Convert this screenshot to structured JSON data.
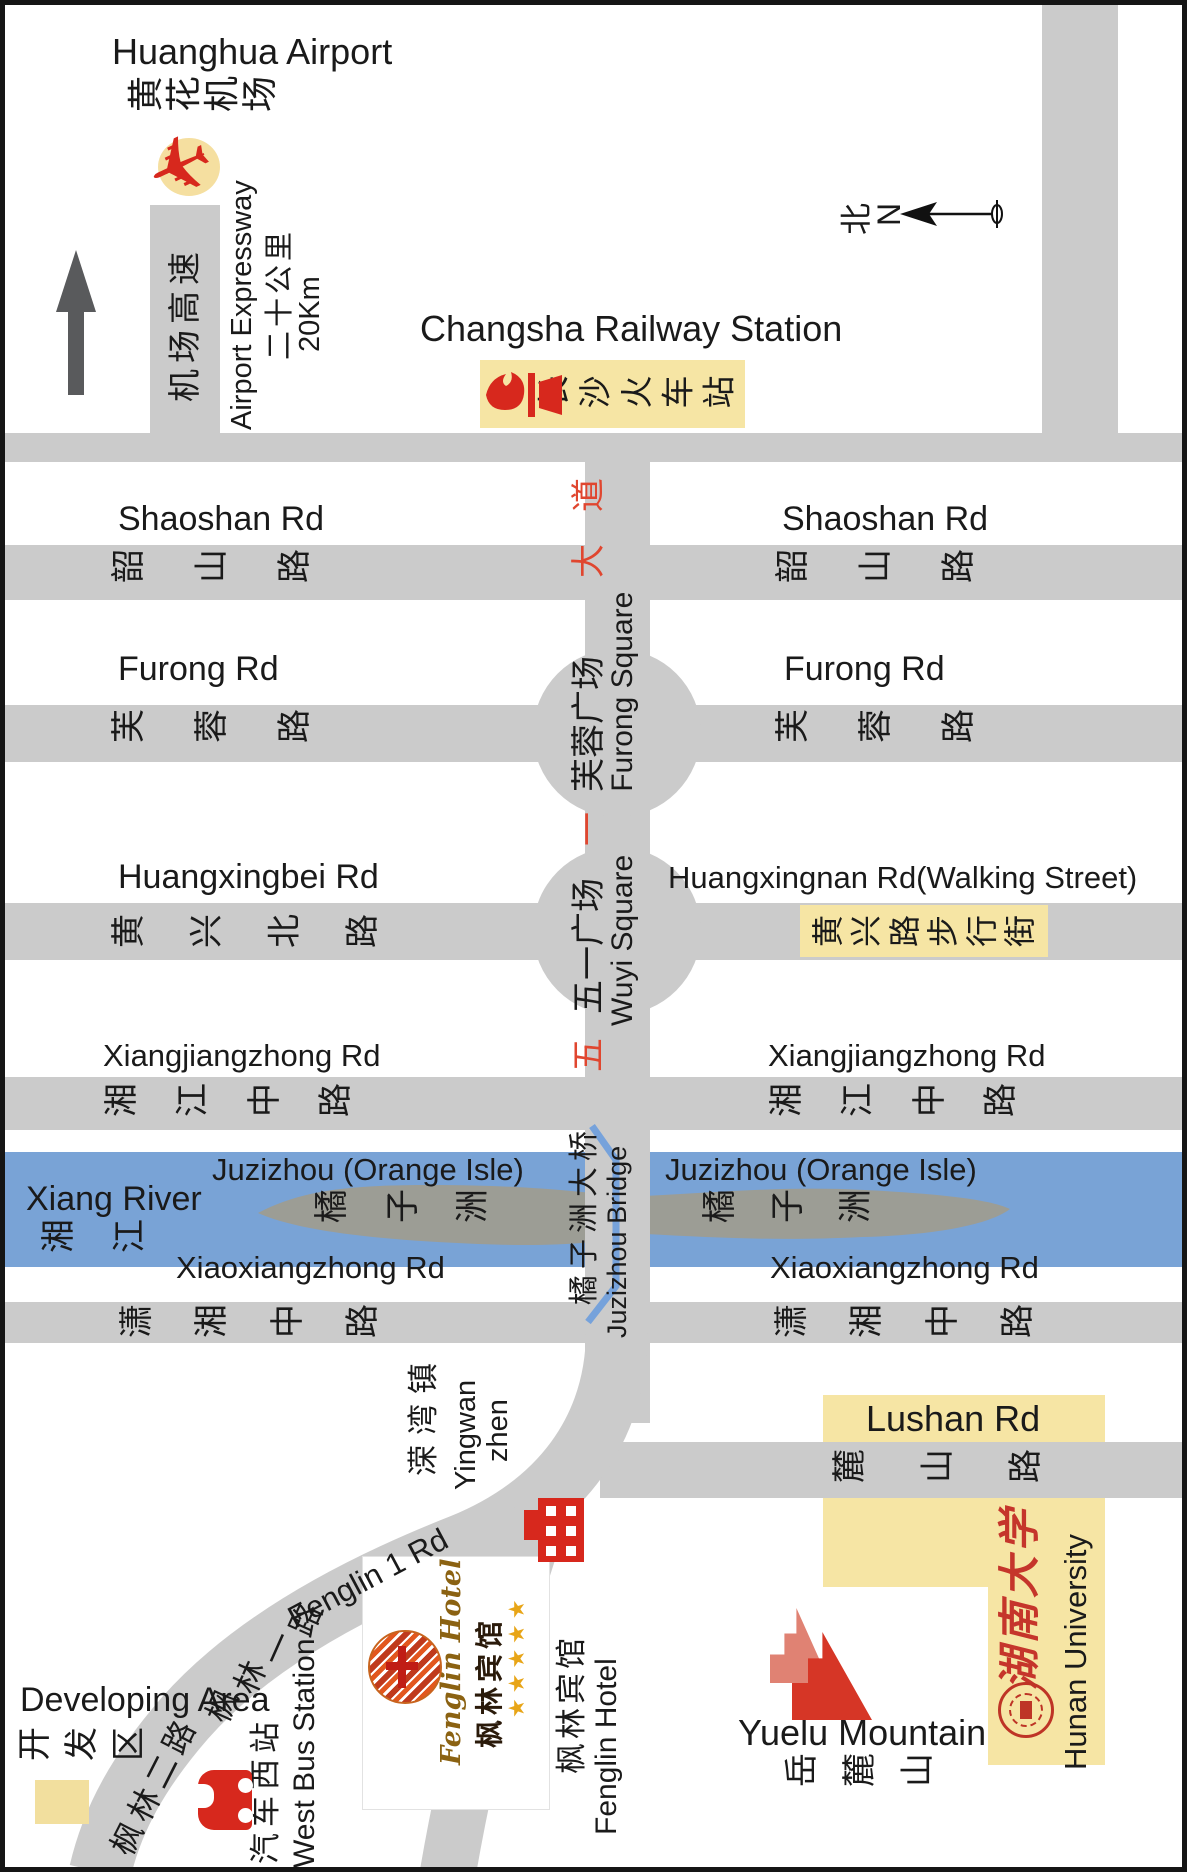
{
  "colors": {
    "road_gray": "#cbcbcb",
    "river_blue": "#79a3d6",
    "island_gray": "#9c9d95",
    "highlight_yellow": "#f6e5a4",
    "icon_red": "#d7281d",
    "avenue_char_red": "#e0462f",
    "dark_arrow": "#595a5c",
    "logo_gold": "#8b6212",
    "star_gold": "#e8a517",
    "univ_red": "#c5352b"
  },
  "airport": {
    "name_en": "Huanghua Airport",
    "name_cn": "黄花机场",
    "expressway_cn": "机场高速",
    "expressway_en": "Airport Expressway",
    "distance_cn": "二十公里",
    "distance_en": "20Km",
    "plane_icon": "✈"
  },
  "station": {
    "name_en": "Changsha Railway Station",
    "name_cn": "长沙火车站"
  },
  "compass": {
    "north_cn": "北",
    "north_en": "N"
  },
  "roads": {
    "shaoshan": {
      "en": "Shaoshan Rd",
      "cn": "韶山路"
    },
    "furong": {
      "en": "Furong Rd",
      "cn": "芙蓉路"
    },
    "huangxingbei": {
      "en": "Huangxingbei Rd",
      "cn": "黄兴北路"
    },
    "huangxingnan": {
      "en": "Huangxingnan Rd(Walking Street)",
      "cn": "黄兴路步行街"
    },
    "xiangjiangzhong": {
      "en": "Xiangjiangzhong Rd",
      "cn": "湘江中路"
    },
    "xiaoxiangzhong": {
      "en": "Xiaoxiangzhong Rd",
      "cn": "潇湘中路"
    },
    "lushan": {
      "en": "Lushan Rd",
      "cn": "麓山路"
    },
    "fenglin1": {
      "en": "Fenglin 1 Rd",
      "cn": "枫林一路"
    },
    "fenglin2": {
      "cn": "枫林二路"
    }
  },
  "avenue": {
    "dao": "道",
    "da": "大",
    "yi": "一",
    "wu": "五",
    "furong_square_cn": "芙蓉广场",
    "furong_square_en": "Furong Square",
    "wuyi_square_cn": "五一广场",
    "wuyi_square_en": "Wuyi Square"
  },
  "river": {
    "name_en": "Xiang River",
    "name_cn": "湘江",
    "isle_en": "Juzizhou (Orange Isle)",
    "isle_cn": "橘子洲"
  },
  "bridge": {
    "cn": "橘子洲大桥",
    "en": "Juzizhou Bridge"
  },
  "southwest": {
    "yingwan_cn": "溁湾镇",
    "yingwan_en_line1": "Yingwan",
    "yingwan_en_line2": "zhen",
    "developing_en": "Developing Area",
    "developing_cn": "开发区",
    "west_bus_cn": "汽车西站",
    "west_bus_en": "West Bus Station"
  },
  "hotel": {
    "logo_script": "Fenglin Hotel",
    "logo_cn": "枫林宾馆",
    "stars": "★★★★★",
    "label_cn": "枫林宾馆",
    "label_en": "Fenglin Hotel"
  },
  "southeast": {
    "yuelu_en": "Yuelu Mountain",
    "yuelu_cn": "岳麓山",
    "university_cn": "湖南大学",
    "university_en": "Hunan University"
  }
}
